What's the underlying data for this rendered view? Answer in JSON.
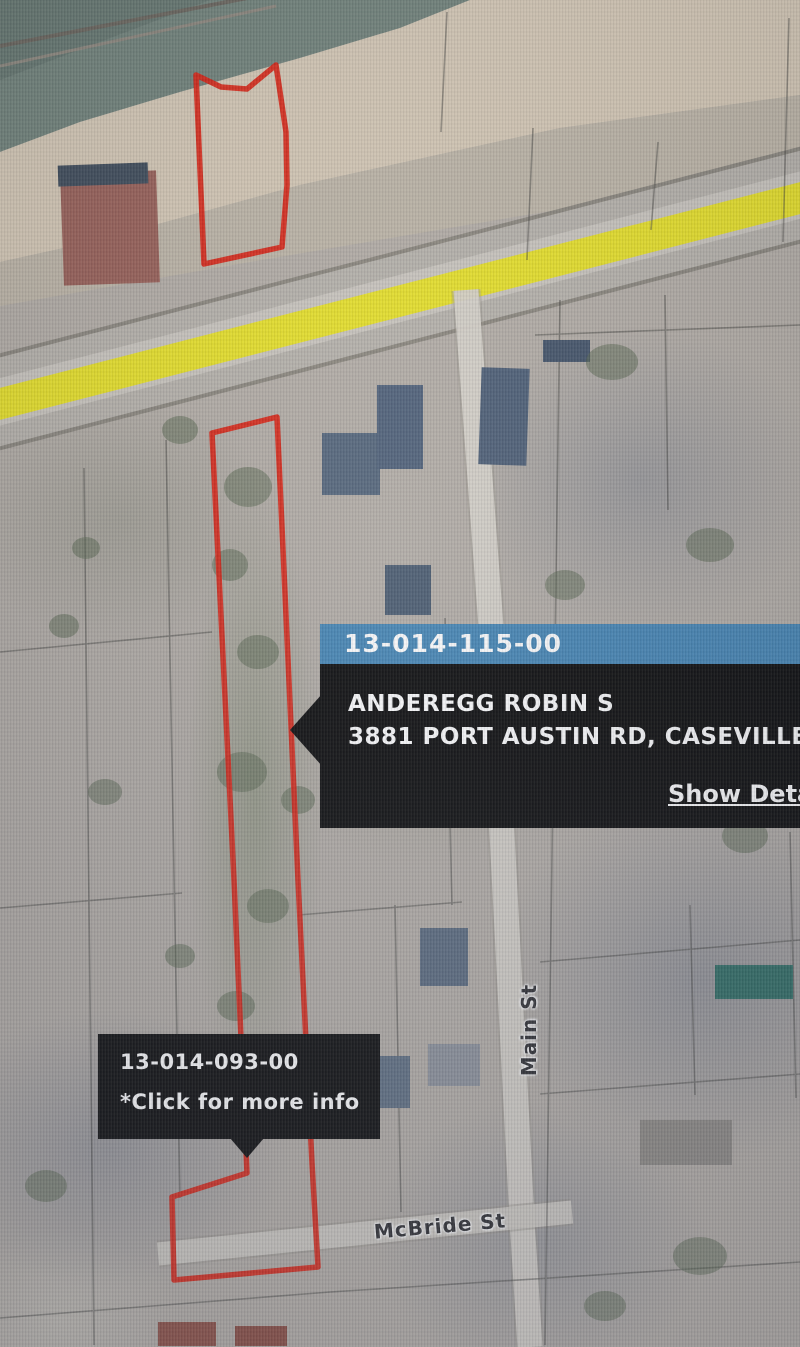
{
  "popup": {
    "parcel_id": "13-014-115-00",
    "owner_name": "ANDEREGG ROBIN S",
    "address": "3881 PORT AUSTIN RD, CASEVILLE",
    "details_link": "Show Details"
  },
  "tooltip": {
    "parcel_id": "13-014-093-00",
    "hint": "*Click for more info"
  },
  "street_labels": {
    "main": "Main St",
    "mcbride": "McBride St"
  },
  "map": {
    "view_type": "aerial parcel map",
    "selected_parcel_outline_color": "#d92313",
    "highlighted_road_color": "#e9e320",
    "popup_header_color": "#4586b5",
    "popup_body_color": "#0a0a0a"
  }
}
